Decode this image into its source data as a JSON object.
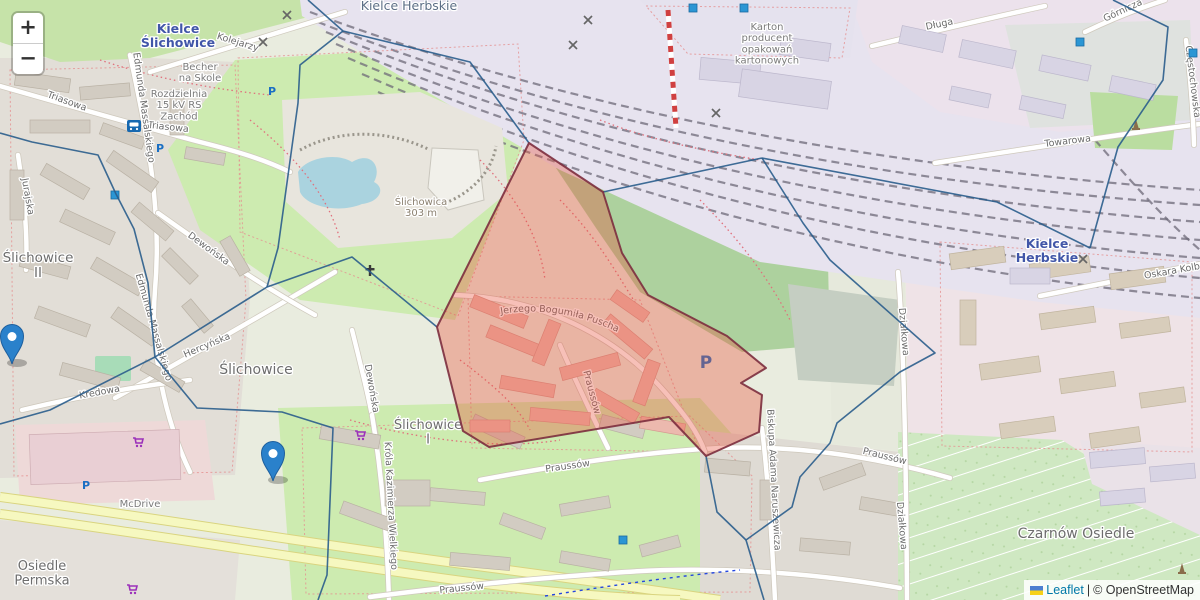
{
  "map": {
    "controls": {
      "zoom_in_label": "+",
      "zoom_out_label": "−"
    },
    "attribution": {
      "flag_icon": "ukraine-flag",
      "leaflet_link": "Leaflet",
      "separator": "|",
      "copyright": "© OpenStreetMap"
    },
    "colors": {
      "boundary_blue": "#2a5d8c",
      "highlight_fill": "#e8503a",
      "highlight_stroke": "#7c2d3e",
      "marker_blue": "#2A81CB",
      "station_label_blue": "#4156a8",
      "parking_blue": "#1a6fc4",
      "supermarket_purple": "#9b30ba",
      "water": "#aad3df"
    },
    "place_labels": [
      {
        "lines": [
          "Kielce Herbskie"
        ],
        "x": 409,
        "y": 10,
        "size": 12.5,
        "color": "#5d6f86",
        "bold": false
      },
      {
        "lines": [
          "Kielce",
          "Ślichowice"
        ],
        "x": 178,
        "y": 33,
        "size": 12.5,
        "color": "#4156a8",
        "bold": true
      },
      {
        "lines": [
          "Kielce",
          "Herbskie"
        ],
        "x": 1047,
        "y": 248,
        "size": 12.5,
        "color": "#4156a8",
        "bold": true
      },
      {
        "lines": [
          "Ślichowice",
          "II"
        ],
        "x": 38,
        "y": 262,
        "size": 13.5,
        "color": "#6d6d6d",
        "bold": false
      },
      {
        "lines": [
          "Ślichowice"
        ],
        "x": 256,
        "y": 374,
        "size": 14,
        "color": "#6d6d6d",
        "bold": false
      },
      {
        "lines": [
          "Ślichowice",
          "I"
        ],
        "x": 428,
        "y": 429,
        "size": 13,
        "color": "#6d6d6d",
        "bold": false
      },
      {
        "lines": [
          "Czarnów Osiedle"
        ],
        "x": 1076,
        "y": 538,
        "size": 14,
        "color": "#6d6d6d",
        "bold": false
      },
      {
        "lines": [
          "Osiedle",
          "Permska"
        ],
        "x": 42,
        "y": 570,
        "size": 13,
        "color": "#6d6d6d",
        "bold": false
      },
      {
        "lines": [
          "Ślichowica",
          "303 m"
        ],
        "x": 421,
        "y": 205,
        "size": 10,
        "color": "#8b8070",
        "bold": false
      },
      {
        "lines": [
          "Becher",
          "na Skole"
        ],
        "x": 200,
        "y": 70,
        "size": 10,
        "color": "#7a7a7a",
        "bold": false
      },
      {
        "lines": [
          "Rozdzielnia",
          "15 kV RS",
          "Zachód"
        ],
        "x": 179,
        "y": 97,
        "size": 10,
        "color": "#7a7a7a",
        "bold": false
      },
      {
        "lines": [
          "Karton",
          "producent",
          "opakowań",
          "kartonowych"
        ],
        "x": 767,
        "y": 30,
        "size": 10,
        "color": "#7a7a7a",
        "bold": false
      },
      {
        "lines": [
          "McDrive"
        ],
        "x": 140,
        "y": 507,
        "size": 10,
        "color": "#7a7a7a",
        "bold": false
      }
    ],
    "street_labels": [
      {
        "text": "Kolejarzy",
        "x": 237,
        "y": 45,
        "rot": 17
      },
      {
        "text": "Triasowa",
        "x": 66,
        "y": 104,
        "rot": 20
      },
      {
        "text": "Triasowa",
        "x": 168,
        "y": 130,
        "rot": 6
      },
      {
        "text": "Edmunda Massalskiego",
        "x": 141,
        "y": 108,
        "rot": 82
      },
      {
        "text": "Edmunda Massalskiego",
        "x": 151,
        "y": 328,
        "rot": 74
      },
      {
        "text": "Długa",
        "x": 940,
        "y": 27,
        "rot": -12
      },
      {
        "text": "Górnicza",
        "x": 1124,
        "y": 13,
        "rot": -25
      },
      {
        "text": "Towarowa",
        "x": 1068,
        "y": 144,
        "rot": -7
      },
      {
        "text": "Częstochowska",
        "x": 1190,
        "y": 82,
        "rot": 83
      },
      {
        "text": "Oskara Kolberga",
        "x": 1183,
        "y": 272,
        "rot": -10
      },
      {
        "text": "Jurajska",
        "x": 25,
        "y": 197,
        "rot": 80
      },
      {
        "text": "Hercyńska",
        "x": 208,
        "y": 348,
        "rot": -23
      },
      {
        "text": "Dewońska",
        "x": 207,
        "y": 251,
        "rot": 36
      },
      {
        "text": "Dewońska",
        "x": 369,
        "y": 389,
        "rot": 80
      },
      {
        "text": "Kredowa",
        "x": 100,
        "y": 395,
        "rot": -10
      },
      {
        "text": "Króla Kazimierza Wielkiego",
        "x": 388,
        "y": 506,
        "rot": 87
      },
      {
        "text": "Praussów",
        "x": 568,
        "y": 469,
        "rot": -8
      },
      {
        "text": "Praussów",
        "x": 884,
        "y": 459,
        "rot": 14
      },
      {
        "text": "Praussów",
        "x": 462,
        "y": 591,
        "rot": -6
      },
      {
        "text": "Praussów",
        "x": 589,
        "y": 393,
        "rot": 75
      },
      {
        "text": "Biskupa Adama Naruszewicza",
        "x": 771,
        "y": 480,
        "rot": 87
      },
      {
        "text": "Działkowa",
        "x": 901,
        "y": 332,
        "rot": 85
      },
      {
        "text": "Działkowa",
        "x": 899,
        "y": 526,
        "rot": 85
      }
    ],
    "curved_street_label": {
      "text": "Jerzego Bogumiła Puscha",
      "path": "M492,316 C560,300 640,328 694,392"
    },
    "pois": {
      "parking": [
        {
          "x": 272,
          "y": 95,
          "s": 11
        },
        {
          "x": 160,
          "y": 152,
          "s": 11
        },
        {
          "x": 706,
          "y": 368,
          "s": 17
        },
        {
          "x": 86,
          "y": 489,
          "s": 11
        }
      ],
      "parking_glyph": "P",
      "supermarkets": [
        {
          "x": 138,
          "y": 444
        },
        {
          "x": 360,
          "y": 437
        },
        {
          "x": 132,
          "y": 591
        }
      ],
      "churches": [
        {
          "x": 370,
          "y": 272
        }
      ],
      "monuments": [
        {
          "x": 1136,
          "y": 128
        },
        {
          "x": 1182,
          "y": 572
        }
      ],
      "rail_crossings": [
        {
          "x": 287,
          "y": 15
        },
        {
          "x": 263,
          "y": 42
        },
        {
          "x": 588,
          "y": 20
        },
        {
          "x": 573,
          "y": 45
        },
        {
          "x": 716,
          "y": 113
        },
        {
          "x": 1083,
          "y": 259
        }
      ],
      "shops": [
        {
          "x": 693,
          "y": 8
        },
        {
          "x": 744,
          "y": 8
        },
        {
          "x": 1080,
          "y": 42
        },
        {
          "x": 115,
          "y": 195
        },
        {
          "x": 623,
          "y": 540
        },
        {
          "x": 1193,
          "y": 53
        }
      ],
      "bus_stops": [
        {
          "x": 134,
          "y": 126
        }
      ]
    },
    "markers": [
      {
        "x": 273,
        "y": 481,
        "note": "pin over Ślichowice block"
      },
      {
        "x": 12,
        "y": 364,
        "note": "pin clipped at left edge"
      }
    ],
    "highlight_polygon": {
      "points": [
        [
          529,
          143
        ],
        [
          603,
          192
        ],
        [
          622,
          253
        ],
        [
          648,
          295
        ],
        [
          727,
          336
        ],
        [
          766,
          368
        ],
        [
          741,
          383
        ],
        [
          762,
          395
        ],
        [
          759,
          432
        ],
        [
          706,
          456
        ],
        [
          669,
          417
        ],
        [
          489,
          447
        ],
        [
          463,
          431
        ],
        [
          437,
          327
        ]
      ]
    },
    "boundary_lines": [
      [
        [
          308,
          0
        ],
        [
          343,
          31
        ],
        [
          470,
          62
        ],
        [
          529,
          143
        ]
      ],
      [
        [
          603,
          192
        ],
        [
          762,
          158
        ]
      ],
      [
        [
          762,
          158
        ],
        [
          997,
          202
        ],
        [
          1090,
          248
        ]
      ],
      [
        [
          1113,
          0
        ],
        [
          1168,
          27
        ],
        [
          1163,
          80
        ],
        [
          1118,
          147
        ],
        [
          1090,
          248
        ]
      ],
      [
        [
          762,
          158
        ],
        [
          803,
          223
        ],
        [
          830,
          260
        ],
        [
          935,
          353
        ],
        [
          900,
          372
        ],
        [
          837,
          423
        ],
        [
          830,
          443
        ],
        [
          800,
          477
        ],
        [
          792,
          507
        ],
        [
          746,
          540
        ],
        [
          764,
          600
        ]
      ],
      [
        [
          706,
          456
        ],
        [
          717,
          512
        ],
        [
          746,
          540
        ]
      ],
      [
        [
          0,
          133
        ],
        [
          32,
          142
        ],
        [
          98,
          155
        ],
        [
          116,
          194
        ],
        [
          134,
          229
        ],
        [
          148,
          283
        ],
        [
          155,
          357
        ]
      ],
      [
        [
          155,
          357
        ],
        [
          50,
          410
        ],
        [
          0,
          424
        ]
      ],
      [
        [
          155,
          357
        ],
        [
          197,
          408
        ],
        [
          282,
          412
        ],
        [
          333,
          428
        ],
        [
          327,
          575
        ],
        [
          318,
          600
        ]
      ],
      [
        [
          155,
          357
        ],
        [
          267,
          287
        ],
        [
          352,
          257
        ],
        [
          437,
          327
        ]
      ],
      [
        [
          343,
          31
        ],
        [
          300,
          65
        ],
        [
          298,
          103
        ],
        [
          278,
          248
        ],
        [
          267,
          287
        ]
      ]
    ]
  }
}
